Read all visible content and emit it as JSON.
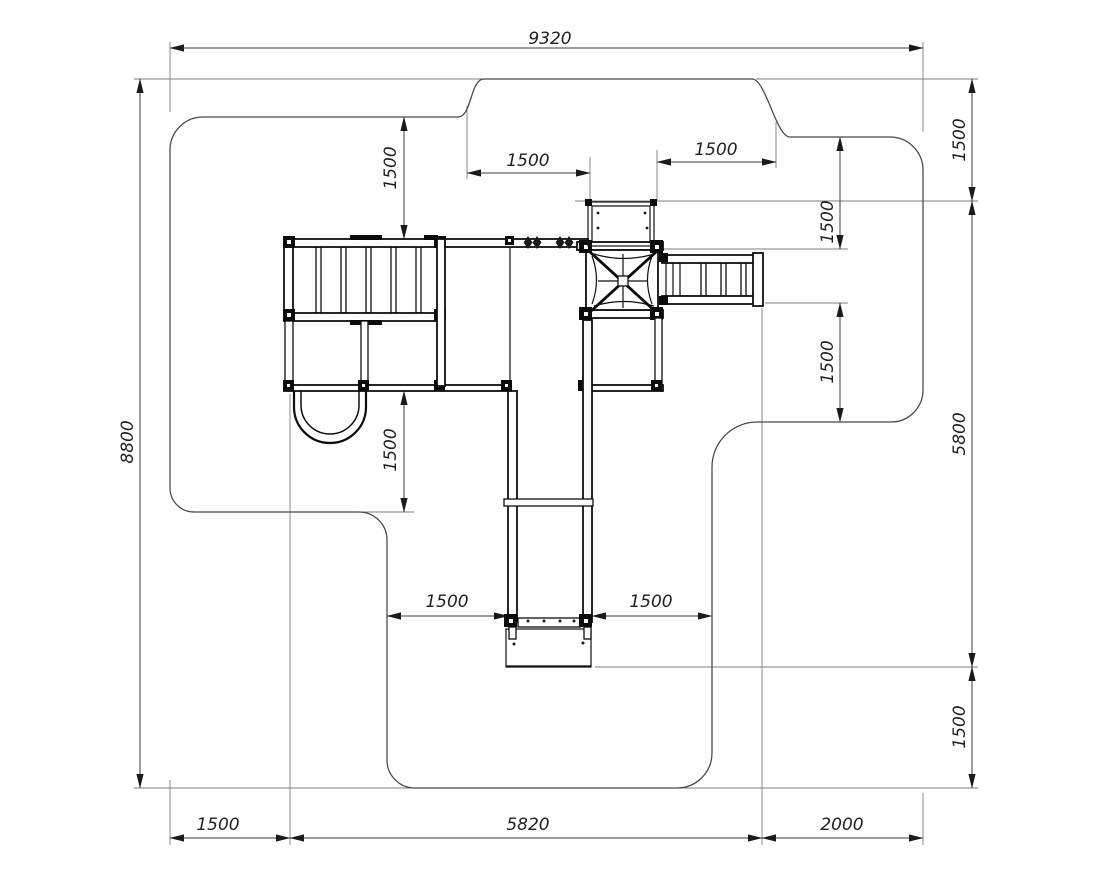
{
  "dims": {
    "zone_width": "9320",
    "zone_height": "8800",
    "right_top_offset": "1500",
    "equipment_height": "5800",
    "right_bottom_offset": "1500",
    "top_clearance": "1500",
    "top_gap_left": "1500",
    "top_gap_right": "1500",
    "right_upper_clearance": "1500",
    "right_lower_clearance": "1500",
    "left_lower_clearance": "1500",
    "slide_gap_left": "1500",
    "slide_gap_right": "1500",
    "bottom_left_offset": "1500",
    "equipment_width": "5820",
    "bottom_right_offset": "2000"
  }
}
